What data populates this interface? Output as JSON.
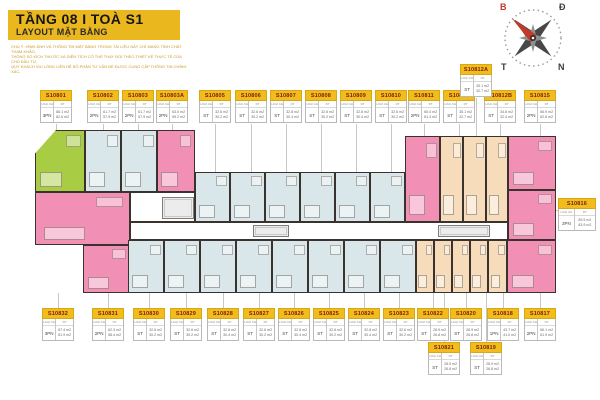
{
  "header": {
    "title": "TẦNG 08  I  TOÀ S1",
    "subtitle": "LAYOUT MẶT BẰNG"
  },
  "disclaimer": {
    "line1": "CHÚ Ý: HÌNH ẢNH VÀ THÔNG TIN MẶT BẰNG TRONG TÀI LIỆU NÀY CHỈ MANG TÍNH CHẤT THAM KHẢO,",
    "line2": "THÔNG SỐ KÍCH THƯỚC VÀ DIỆN TÍCH CÓ THỂ THAY ĐỔI THEO THIẾT KẾ THỰC TẾ CỦA CHỦ ĐẦU TƯ,",
    "line3": "QUÝ KHÁCH VUI LÒNG LIÊN HỆ BỘ PHẬN TƯ VẤN ĐỂ ĐƯỢC CUNG CẤP THÔNG TIN CHÍNH XÁC."
  },
  "compass": {
    "top_left": "B",
    "top_right": "Đ",
    "bottom_left": "T",
    "bottom_right": "N"
  },
  "colors": {
    "accent_yellow": "#eab71e",
    "card_yellow": "#f0bd1d",
    "card_text": "#7d1d12",
    "pink": "#f28fb4",
    "blue": "#d9e7ea",
    "green": "#a8cc44",
    "cream": "#f6dcba",
    "wall": "#3a322c",
    "needle_red": "#c23a2c"
  },
  "card_labels": {
    "type": "LOẠI CH",
    "area": "DT"
  },
  "cards": [
    {
      "c": "S10801",
      "x": 40,
      "y": 90,
      "ly": 130,
      "t": "3PN",
      "a1": "88.1 m2",
      "a2": "82.6 m2"
    },
    {
      "c": "S10802",
      "x": 87,
      "y": 90,
      "ly": 130,
      "t": "2PN",
      "a1": "61.7 m2",
      "a2": "57.9 m2"
    },
    {
      "c": "S10803",
      "x": 122,
      "y": 90,
      "ly": 130,
      "t": "2PN",
      "a1": "61.7 m2",
      "a2": "57.9 m2"
    },
    {
      "c": "S10803A",
      "x": 156,
      "y": 90,
      "ly": 130,
      "t": "2PN",
      "a1": "63.0 m2",
      "a2": "59.2 m2"
    },
    {
      "c": "S10805",
      "x": 199,
      "y": 90,
      "ly": 172,
      "t": "ST",
      "a1": "32.6 m2",
      "a2": "30.2 m2"
    },
    {
      "c": "S10806",
      "x": 235,
      "y": 90,
      "ly": 172,
      "t": "ST",
      "a1": "32.6 m2",
      "a2": "30.2 m2"
    },
    {
      "c": "S10807",
      "x": 270,
      "y": 90,
      "ly": 172,
      "t": "ST",
      "a1": "32.8 m2",
      "a2": "30.4 m2"
    },
    {
      "c": "S10808",
      "x": 305,
      "y": 90,
      "ly": 172,
      "t": "ST",
      "a1": "32.6 m2",
      "a2": "30.2 m2"
    },
    {
      "c": "S10809",
      "x": 340,
      "y": 90,
      "ly": 172,
      "t": "ST",
      "a1": "32.8 m2",
      "a2": "30.4 m2"
    },
    {
      "c": "S10810",
      "x": 375,
      "y": 90,
      "ly": 172,
      "t": "ST",
      "a1": "32.6 m2",
      "a2": "30.2 m2"
    },
    {
      "c": "S10811",
      "x": 408,
      "y": 90,
      "ly": 136,
      "t": "2PN",
      "a1": "65.4 m2",
      "a2": "61.3 m2"
    },
    {
      "c": "S10812",
      "x": 443,
      "y": 90,
      "ly": 136,
      "t": "ST",
      "a1": "35.1 m2",
      "a2": "32.7 m2"
    },
    {
      "c": "S10812B",
      "x": 484,
      "y": 90,
      "ly": 136,
      "t": "ST",
      "a1": "34.8 m2",
      "a2": "32.4 m2"
    },
    {
      "c": "S10815",
      "x": 524,
      "y": 90,
      "ly": 136,
      "t": "2PN",
      "a1": "66.9 m2",
      "a2": "62.8 m2"
    },
    {
      "c": "S10812A",
      "x": 460,
      "y": 64,
      "ly": 136,
      "t": "ST",
      "a1": "35.1 m2",
      "a2": "32.7 m2"
    },
    {
      "c": "S10816",
      "x": 558,
      "y": 198,
      "w": 38,
      "hz": 1,
      "t": "3PN",
      "a1": "89.5 m2",
      "a2": "83.9 m2"
    },
    {
      "c": "S10832",
      "x": 42,
      "y": 308,
      "t": "3PN",
      "a1": "87.4 m2",
      "a2": "81.9 m2"
    },
    {
      "c": "S10831",
      "x": 92,
      "y": 308,
      "t": "2PN",
      "a1": "62.3 m2",
      "a2": "58.4 m2"
    },
    {
      "c": "S10830",
      "x": 133,
      "y": 308,
      "t": "ST",
      "a1": "32.6 m2",
      "a2": "30.2 m2"
    },
    {
      "c": "S10829",
      "x": 170,
      "y": 308,
      "t": "ST",
      "a1": "32.6 m2",
      "a2": "30.2 m2"
    },
    {
      "c": "S10828",
      "x": 207,
      "y": 308,
      "t": "ST",
      "a1": "32.8 m2",
      "a2": "30.4 m2"
    },
    {
      "c": "S10827",
      "x": 243,
      "y": 308,
      "t": "ST",
      "a1": "32.6 m2",
      "a2": "30.2 m2"
    },
    {
      "c": "S10826",
      "x": 278,
      "y": 308,
      "t": "ST",
      "a1": "32.8 m2",
      "a2": "30.4 m2"
    },
    {
      "c": "S10825",
      "x": 313,
      "y": 308,
      "t": "ST",
      "a1": "32.6 m2",
      "a2": "30.2 m2"
    },
    {
      "c": "S10824",
      "x": 348,
      "y": 308,
      "t": "ST",
      "a1": "32.8 m2",
      "a2": "30.4 m2"
    },
    {
      "c": "S10823",
      "x": 383,
      "y": 308,
      "t": "ST",
      "a1": "32.6 m2",
      "a2": "30.2 m2"
    },
    {
      "c": "S10822",
      "x": 417,
      "y": 308,
      "t": "ST",
      "a1": "28.9 m2",
      "a2": "26.8 m2"
    },
    {
      "c": "S10820",
      "x": 450,
      "y": 308,
      "t": "ST",
      "a1": "28.9 m2",
      "a2": "26.8 m2"
    },
    {
      "c": "S10818",
      "x": 487,
      "y": 308,
      "t": "1PN",
      "a1": "43.7 m2",
      "a2": "41.0 m2"
    },
    {
      "c": "S10817",
      "x": 524,
      "y": 308,
      "t": "2PN",
      "a1": "66.1 m2",
      "a2": "61.9 m2"
    },
    {
      "c": "S10821",
      "x": 428,
      "y": 342,
      "t": "ST",
      "a1": "28.9 m2",
      "a2": "26.8 m2"
    },
    {
      "c": "S10819",
      "x": 470,
      "y": 342,
      "t": "ST",
      "a1": "28.9 m2",
      "a2": "26.8 m2"
    }
  ],
  "plan": {
    "units": [
      {
        "c": "S10801",
        "col": "green",
        "x": 35,
        "y": 130,
        "w": 50,
        "h": 62,
        "clip": 1
      },
      {
        "c": "S10802",
        "col": "blue",
        "x": 85,
        "y": 130,
        "w": 36,
        "h": 62
      },
      {
        "c": "S10803",
        "col": "blue",
        "x": 121,
        "y": 130,
        "w": 36,
        "h": 62
      },
      {
        "c": "S10803A",
        "col": "pink",
        "x": 157,
        "y": 130,
        "w": 38,
        "h": 62
      },
      {
        "c": "S10832",
        "col": "pink",
        "x": 35,
        "y": 192,
        "w": 95,
        "h": 53
      },
      {
        "c": "S10831",
        "col": "pink",
        "x": 83,
        "y": 245,
        "w": 47,
        "h": 48
      },
      {
        "c": "S10805",
        "col": "blue",
        "x": 195,
        "y": 172,
        "w": 35,
        "h": 50
      },
      {
        "c": "S10806",
        "col": "blue",
        "x": 230,
        "y": 172,
        "w": 35,
        "h": 50
      },
      {
        "c": "S10807",
        "col": "blue",
        "x": 265,
        "y": 172,
        "w": 35,
        "h": 50
      },
      {
        "c": "S10808",
        "col": "blue",
        "x": 300,
        "y": 172,
        "w": 35,
        "h": 50
      },
      {
        "c": "S10809",
        "col": "blue",
        "x": 335,
        "y": 172,
        "w": 35,
        "h": 50
      },
      {
        "c": "S10810",
        "col": "blue",
        "x": 370,
        "y": 172,
        "w": 35,
        "h": 50
      },
      {
        "c": "S10811",
        "col": "pink",
        "x": 405,
        "y": 136,
        "w": 35,
        "h": 86
      },
      {
        "c": "S10812A",
        "col": "cream",
        "x": 440,
        "y": 136,
        "w": 23,
        "h": 86
      },
      {
        "c": "S10812",
        "col": "cream",
        "x": 463,
        "y": 136,
        "w": 23,
        "h": 86
      },
      {
        "c": "S10812B",
        "col": "cream",
        "x": 486,
        "y": 136,
        "w": 22,
        "h": 86
      },
      {
        "c": "S10815",
        "col": "pink",
        "x": 508,
        "y": 136,
        "w": 48,
        "h": 54
      },
      {
        "c": "S10816",
        "col": "pink",
        "x": 508,
        "y": 190,
        "w": 48,
        "h": 50
      },
      {
        "c": "S10817",
        "col": "pink",
        "x": 507,
        "y": 240,
        "w": 49,
        "h": 53
      },
      {
        "c": "S10830",
        "col": "blue",
        "x": 128,
        "y": 240,
        "w": 36,
        "h": 53
      },
      {
        "c": "S10829",
        "col": "blue",
        "x": 164,
        "y": 240,
        "w": 36,
        "h": 53
      },
      {
        "c": "S10828",
        "col": "blue",
        "x": 200,
        "y": 240,
        "w": 36,
        "h": 53
      },
      {
        "c": "S10827",
        "col": "blue",
        "x": 236,
        "y": 240,
        "w": 36,
        "h": 53
      },
      {
        "c": "S10826",
        "col": "blue",
        "x": 272,
        "y": 240,
        "w": 36,
        "h": 53
      },
      {
        "c": "S10825",
        "col": "blue",
        "x": 308,
        "y": 240,
        "w": 36,
        "h": 53
      },
      {
        "c": "S10824",
        "col": "blue",
        "x": 344,
        "y": 240,
        "w": 36,
        "h": 53
      },
      {
        "c": "S10823",
        "col": "blue",
        "x": 380,
        "y": 240,
        "w": 36,
        "h": 53
      },
      {
        "c": "S10822",
        "col": "cream",
        "x": 416,
        "y": 240,
        "w": 18,
        "h": 53
      },
      {
        "c": "S10821",
        "col": "cream",
        "x": 434,
        "y": 240,
        "w": 18,
        "h": 53
      },
      {
        "c": "S10820",
        "col": "cream",
        "x": 452,
        "y": 240,
        "w": 18,
        "h": 53
      },
      {
        "c": "S10819",
        "col": "cream",
        "x": 470,
        "y": 240,
        "w": 18,
        "h": 53
      },
      {
        "c": "S10818",
        "col": "cream",
        "x": 488,
        "y": 240,
        "w": 19,
        "h": 53
      }
    ],
    "corridors": [
      {
        "x": 130,
        "y": 222,
        "w": 378,
        "h": 18
      },
      {
        "x": 130,
        "y": 192,
        "w": 65,
        "h": 30
      }
    ],
    "cores": [
      {
        "x": 162,
        "y": 197,
        "w": 32,
        "h": 22
      },
      {
        "x": 253,
        "y": 225,
        "w": 36,
        "h": 12
      },
      {
        "x": 438,
        "y": 225,
        "w": 52,
        "h": 12
      }
    ]
  }
}
